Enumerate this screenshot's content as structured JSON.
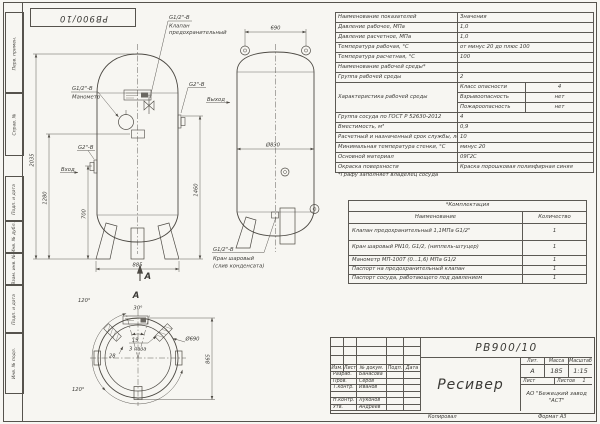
{
  "sheet": {
    "stamp": "РВ900/10",
    "margin_labels": [
      "Перв. примен.",
      "Справ. №",
      "Подп. и дата",
      "Инв. № дубл.",
      "Взам. инв. №",
      "Подп. и дата",
      "Инв. № подл."
    ]
  },
  "drawing": {
    "valve_thread": "G1/2\"-В",
    "valve_name1": "Клапан",
    "valve_name2": "предохранительный",
    "mano_thread": "G1/2\"-В",
    "mano_name": "Манометр",
    "outlet_thread": "G2\"-В",
    "outlet_name": "Выход",
    "inlet_thread": "G2\"-В",
    "inlet_name": "Вход",
    "drain_thread": "G1/2\"-В",
    "drain_name1": "Кран шаровый",
    "drain_name2": "(слив конденсата)",
    "dim_total": "2035",
    "dim_1280": "1280",
    "dim_700": "700",
    "dim_1460": "1460",
    "dim_base": "885",
    "dim_top": "690",
    "dim_dia_side": "Ø830",
    "section_letter": "А",
    "view_letter": "А",
    "plan_dia": "Ø690",
    "plan_height": "865",
    "angle_tl": "120°",
    "angle_bl": "120°",
    "angle_top": "30°",
    "slot_w": "19",
    "slots_note": "3 паза",
    "dim_28": "28"
  },
  "spec": {
    "col1": "Наименование показателей",
    "col2": "Значения",
    "rows_a": [
      {
        "label": "Давление рабочее, МПа",
        "value": "1,0"
      },
      {
        "label": "Давление расчетное, МПа",
        "value": "1,0"
      },
      {
        "label": "Температура рабочая, °С",
        "value": "от минус 20 до плюс 100"
      },
      {
        "label": "Температура расчетная, °С",
        "value": "100"
      },
      {
        "label": "Наименование рабочей среды*",
        "value": ""
      },
      {
        "label": "Группа рабочей среды",
        "value": "2"
      }
    ],
    "char_label": "Характеристика рабочей среды",
    "char": [
      {
        "name": "Класс опасности",
        "value": "4"
      },
      {
        "name": "Взрывоопасность",
        "value": "нет"
      },
      {
        "name": "Пожароопасность",
        "value": "нет"
      }
    ],
    "rows_b": [
      {
        "label": "Группа сосуда по ГОСТ Р 52630-2012",
        "value": "4"
      },
      {
        "label": "Вместимость, м³",
        "value": "0,9"
      },
      {
        "label": "Расчетный и назначенный срок службы, лет",
        "value": "10"
      },
      {
        "label": "Минимальная температура стенки, °С",
        "value": "минус 20"
      },
      {
        "label": "Основной материал",
        "value": "09Г2С"
      },
      {
        "label": "Окраска поверхности",
        "value": "Краска порошковая полиэфирная синяя"
      }
    ],
    "footnote": "*Графу заполняет владелец сосуда"
  },
  "kit": {
    "title": "*Комплектация",
    "col1": "Наименование",
    "col2": "Количество",
    "rows": [
      {
        "name": "Клапан предохранительный 1,1МПа G1/2\"",
        "qty": "1"
      },
      {
        "name": "Кран шаровый PN10, G1/2, (ниппель-штуцер)",
        "qty": "1"
      },
      {
        "name": "Манометр МП-100Т (0...1,6) МПа G1/2",
        "qty": "1"
      },
      {
        "name": "Паспорт на предохранительный клапан",
        "qty": "1"
      },
      {
        "name": "Паспорт сосуда, работающего под давлением",
        "qty": "1"
      }
    ]
  },
  "tb": {
    "designation": "РВ900/10",
    "doc_name": "Ресивер",
    "cols": [
      "Изм.",
      "Лист",
      "№ докум.",
      "Подп.",
      "Дата"
    ],
    "rows": [
      {
        "role": "Разраб.",
        "name": "Банасова"
      },
      {
        "role": "Пров.",
        "name": "Серов"
      },
      {
        "role": "Т.контр.",
        "name": "Иванов"
      },
      {
        "role": "",
        "name": ""
      },
      {
        "role": "Н.контр.",
        "name": "Луконов"
      },
      {
        "role": "Утв.",
        "name": "Андреев"
      }
    ],
    "lit_h": "Лит.",
    "mass_h": "Масса",
    "scale_h": "Масштаб",
    "lit": "А",
    "mass": "185",
    "scale": "1:15",
    "sheet_h": "Лист",
    "sheets_h": "Листов",
    "sheets": "1",
    "company1": "АО \"Бежецкий завод",
    "company2": "\"АСТ\"",
    "copied": "Копировал",
    "format": "Формат А3"
  }
}
